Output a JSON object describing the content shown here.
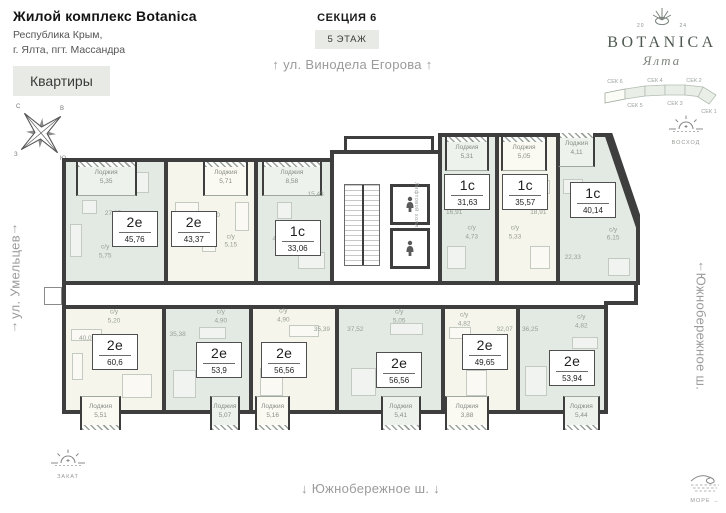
{
  "colors": {
    "accent_bg": "#e8ebe5",
    "wall": "#3e3e3e",
    "green_fill": "#e3eae3",
    "green_loggia": "#edf2ec",
    "cream_fill": "#f6f5eb",
    "cream_loggia": "#fbfaf2"
  },
  "header": {
    "complex_name": "Жилой комплекс Botanica",
    "address_line1": "Республика Крым,",
    "address_line2": "г. Ялта, пгт. Массандра",
    "apartments_button": "Квартиры"
  },
  "plan_header": {
    "section": "СЕКЦИЯ 6",
    "floor": "5 ЭТАЖ"
  },
  "streets": {
    "top": "ул. Винодела Егорова",
    "left": "ул. Умельцев",
    "right": "Южнобережное ш.",
    "bottom": "Южнобережное ш.",
    "arrow_up": "↑",
    "arrow_down": "↓"
  },
  "landmarks": {
    "sunrise": "ВОСХОД",
    "sunset": "ЗАКАТ",
    "sea": "МОРЕ",
    "sea_arrow": "→"
  },
  "logo": {
    "name": "BOTANICA",
    "city": "Ялта",
    "year_left": "20",
    "year_right": "24"
  },
  "compass": {
    "n": "С",
    "e": "В",
    "s": "Ю",
    "w": "З"
  },
  "core": {
    "elevator_hall_label": "Лифтовой холл"
  },
  "section_map": {
    "sections": [
      {
        "label": "СЕК 6",
        "active": true
      },
      {
        "label": "СЕК 5",
        "active": false
      },
      {
        "label": "СЕК 4",
        "active": false
      },
      {
        "label": "СЕК 3",
        "active": false
      },
      {
        "label": "СЕК 2",
        "active": false
      },
      {
        "label": "СЕК 1",
        "active": false
      }
    ]
  },
  "floor_plan": {
    "apartments": [
      {
        "id": "a1",
        "type": "2е",
        "area": "45,76",
        "palette": "green",
        "row": "top",
        "x": 62,
        "y": 158,
        "w": 106,
        "h": 127,
        "label": {
          "x": 70,
          "y": 56
        },
        "loggia": {
          "label": "Лоджия",
          "value": "5,35",
          "left": 10,
          "width": 62
        },
        "annotations": [
          {
            "x": 48,
            "y": 44,
            "lines": [
              "27,85"
            ]
          },
          {
            "x": 40,
            "y": 76,
            "lines": [
              "с/у",
              "5,75"
            ]
          }
        ],
        "furniture": [
          [
            55,
            8,
            28,
            16
          ],
          [
            4,
            52,
            10,
            26
          ],
          [
            16,
            32,
            14,
            10
          ]
        ]
      },
      {
        "id": "a2",
        "type": "2е",
        "area": "43,37",
        "palette": "cream",
        "row": "top",
        "x": 164,
        "y": 158,
        "w": 94,
        "h": 127,
        "label": {
          "x": 30,
          "y": 56
        },
        "loggia": {
          "label": "Лоджия",
          "value": "5,71",
          "left": 41,
          "width": 52
        },
        "annotations": [
          {
            "x": 51,
            "y": 45,
            "lines": [
              "24,50"
            ]
          },
          {
            "x": 73,
            "y": 67,
            "lines": [
              "с/у",
              "5,15"
            ]
          }
        ],
        "furniture": [
          [
            8,
            34,
            26,
            18
          ],
          [
            78,
            34,
            14,
            22
          ],
          [
            40,
            64,
            14,
            10
          ]
        ]
      },
      {
        "id": "a3",
        "type": "1с",
        "area": "33,06",
        "palette": "green",
        "row": "top",
        "x": 254,
        "y": 158,
        "w": 80,
        "h": 127,
        "label": {
          "x": 55,
          "y": 64
        },
        "loggia": {
          "label": "Лоджия",
          "value": "8,58",
          "left": 5,
          "width": 84
        },
        "annotations": [
          {
            "x": 80,
            "y": 28,
            "lines": [
              "15,43"
            ]
          },
          {
            "x": 29,
            "y": 62,
            "lines": [
              "с/у",
              "4,73"
            ]
          }
        ],
        "furniture": [
          [
            26,
            34,
            18,
            12
          ],
          [
            56,
            76,
            34,
            12
          ]
        ]
      },
      {
        "id": "a4",
        "type": "1с",
        "area": "31,63",
        "palette": "green",
        "row": "top",
        "x": 438,
        "y": 133,
        "w": 61,
        "h": 152,
        "label": {
          "x": 48,
          "y": 38
        },
        "loggia": {
          "label": "Лоджия",
          "value": "5,31",
          "left": 6,
          "width": 82
        },
        "annotations": [
          {
            "x": 23,
            "y": 53,
            "lines": [
              "16,91"
            ]
          },
          {
            "x": 56,
            "y": 67,
            "lines": [
              "с/у",
              "4,73"
            ]
          }
        ],
        "furniture": [
          [
            12,
            30,
            26,
            8
          ],
          [
            10,
            76,
            32,
            14
          ]
        ]
      },
      {
        "id": "a5",
        "type": "1с",
        "area": "35,57",
        "palette": "cream",
        "row": "top",
        "x": 495,
        "y": 133,
        "w": 65,
        "h": 152,
        "label": {
          "x": 46,
          "y": 38
        },
        "loggia": {
          "label": "Лоджия",
          "value": "5,05",
          "left": 4,
          "width": 80
        },
        "annotations": [
          {
            "x": 69,
            "y": 53,
            "lines": [
              "18,91"
            ]
          },
          {
            "x": 28,
            "y": 67,
            "lines": [
              "с/у",
              "5,33"
            ]
          }
        ],
        "furniture": [
          [
            58,
            30,
            28,
            8
          ],
          [
            54,
            76,
            32,
            14
          ]
        ]
      },
      {
        "id": "a6",
        "type": "1с",
        "area": "40,14",
        "palette": "green",
        "row": "top",
        "x": 556,
        "y": 133,
        "w": 84,
        "h": 152,
        "label": {
          "x": 44,
          "y": 44
        },
        "shape": [
          [
            0,
            0
          ],
          [
            52,
            0
          ],
          [
            84,
            94
          ],
          [
            84,
            152
          ],
          [
            0,
            152
          ]
        ],
        "loggia": {
          "label": "Лоджия",
          "value": "4,11",
          "left": 2,
          "width": 45
        },
        "annotations": [
          {
            "x": 20,
            "y": 82,
            "lines": [
              "22,33"
            ]
          },
          {
            "x": 68,
            "y": 67,
            "lines": [
              "с/у",
              "6,15"
            ]
          }
        ],
        "furniture": [
          [
            8,
            30,
            22,
            9
          ],
          [
            62,
            82,
            24,
            11
          ]
        ]
      },
      {
        "id": "b1",
        "type": "2е",
        "area": "60,6",
        "palette": "cream",
        "row": "bottom",
        "x": 62,
        "y": 305,
        "w": 104,
        "h": 109,
        "label": {
          "x": 51,
          "y": 43
        },
        "loggia": {
          "label": "Лоджия",
          "value": "5,51",
          "left": 15,
          "width": 42
        },
        "annotations": [
          {
            "x": 22,
            "y": 30,
            "lines": [
              "40,07"
            ]
          },
          {
            "x": 50,
            "y": 8,
            "lines": [
              "с/у",
              "5,20"
            ]
          }
        ],
        "furniture": [
          [
            58,
            64,
            30,
            22
          ],
          [
            5,
            20,
            30,
            10
          ],
          [
            6,
            44,
            10,
            24
          ]
        ]
      },
      {
        "id": "b2",
        "type": "2е",
        "area": "53,9",
        "palette": "green",
        "row": "bottom",
        "x": 162,
        "y": 305,
        "w": 91,
        "h": 109,
        "label": {
          "x": 64,
          "y": 50
        },
        "loggia": {
          "label": "Лоджия",
          "value": "5,07",
          "left": 53,
          "width": 36
        },
        "annotations": [
          {
            "x": 14,
            "y": 26,
            "lines": [
              "35,38"
            ]
          },
          {
            "x": 66,
            "y": 8,
            "lines": [
              "с/у",
              "4,90"
            ]
          }
        ],
        "furniture": [
          [
            8,
            60,
            26,
            26
          ],
          [
            40,
            18,
            30,
            10
          ]
        ]
      },
      {
        "id": "b3",
        "type": "2е",
        "area": "56,56",
        "palette": "cream",
        "row": "bottom",
        "x": 249,
        "y": 305,
        "w": 90,
        "h": 109,
        "label": {
          "x": 38,
          "y": 50
        },
        "loggia": {
          "label": "Лоджия",
          "value": "5,16",
          "left": 3,
          "width": 42
        },
        "annotations": [
          {
            "x": 84,
            "y": 21,
            "lines": [
              "35,39"
            ]
          },
          {
            "x": 37,
            "y": 7,
            "lines": [
              "с/у",
              "4,90"
            ]
          }
        ],
        "furniture": [
          [
            8,
            58,
            26,
            26
          ],
          [
            44,
            16,
            34,
            10
          ]
        ]
      },
      {
        "id": "b4",
        "type": "2е",
        "area": "56,56",
        "palette": "green",
        "row": "bottom",
        "x": 335,
        "y": 305,
        "w": 110,
        "h": 109,
        "label": {
          "x": 59,
          "y": 60
        },
        "loggia": {
          "label": "Лоджия",
          "value": "5,41",
          "left": 41,
          "width": 39
        },
        "annotations": [
          {
            "x": 16,
            "y": 21,
            "lines": [
              "37,52"
            ]
          },
          {
            "x": 59,
            "y": 8,
            "lines": [
              "с/у",
              "5,05"
            ]
          }
        ],
        "furniture": [
          [
            12,
            58,
            22,
            26
          ],
          [
            50,
            14,
            30,
            10
          ]
        ]
      },
      {
        "id": "b5",
        "type": "2е",
        "area": "49,65",
        "palette": "cream",
        "row": "bottom",
        "x": 441,
        "y": 305,
        "w": 79,
        "h": 109,
        "label": {
          "x": 56,
          "y": 43
        },
        "loggia": {
          "label": "Лоджия",
          "value": "3,88",
          "left": 0,
          "width": 62
        },
        "annotations": [
          {
            "x": 84,
            "y": 21,
            "lines": [
              "32,07"
            ]
          },
          {
            "x": 27,
            "y": 11,
            "lines": [
              "с/у",
              "4,82"
            ]
          }
        ],
        "furniture": [
          [
            30,
            60,
            26,
            24
          ],
          [
            6,
            18,
            28,
            10
          ]
        ]
      },
      {
        "id": "b6",
        "type": "2е",
        "area": "53,94",
        "palette": "green",
        "row": "bottom",
        "x": 516,
        "y": 305,
        "w": 92,
        "h": 109,
        "label": {
          "x": 62,
          "y": 58
        },
        "loggia": {
          "label": "Лоджия",
          "value": "5,44",
          "left": 51,
          "width": 44
        },
        "annotations": [
          {
            "x": 12,
            "y": 21,
            "lines": [
              "36,25"
            ]
          },
          {
            "x": 73,
            "y": 13,
            "lines": [
              "с/у",
              "4,82"
            ]
          }
        ],
        "furniture": [
          [
            6,
            56,
            24,
            28
          ],
          [
            62,
            28,
            28,
            10
          ]
        ]
      }
    ]
  }
}
